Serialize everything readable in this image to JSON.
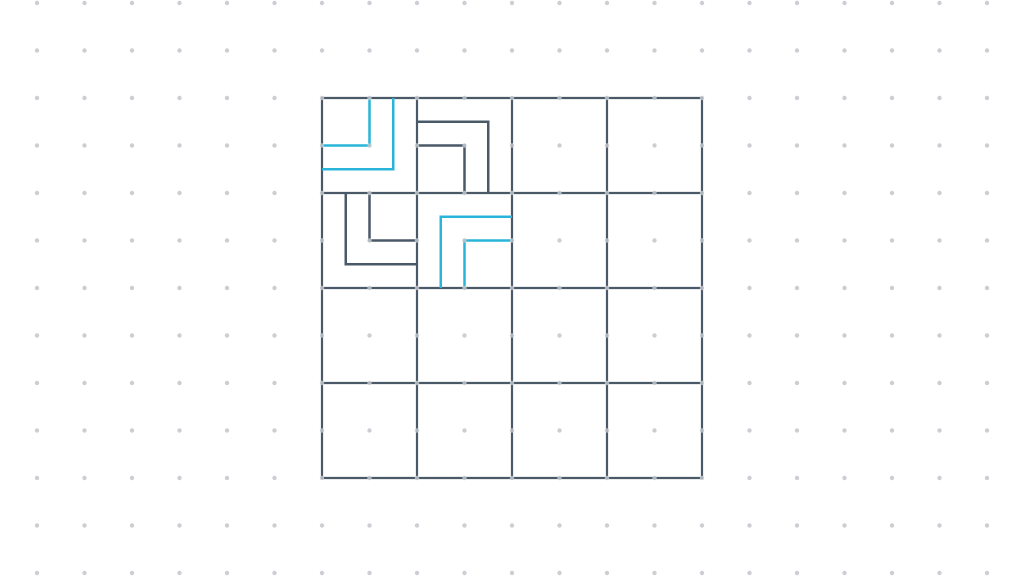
{
  "canvas": {
    "width": 1024,
    "height": 576,
    "background": "#ffffff"
  },
  "dot_grid": {
    "spacing": 47.5,
    "anchor_x": 322,
    "anchor_y": 98,
    "radius": 2.2,
    "color": "#c2c6cb",
    "opacity": 0.85
  },
  "grid": {
    "x": 322,
    "y": 98,
    "rows": 4,
    "cols": 4,
    "cell_size": 95,
    "line_color": "#4a5968",
    "line_width": 2.2
  },
  "colors": {
    "dark": "#4a5968",
    "cyan": "#28b5d9"
  },
  "shape_line_width": 2.5,
  "shapes": [
    {
      "name": "elbow-cell-0-0-inner",
      "cell": [
        0,
        0
      ],
      "connects": [
        "top",
        "left"
      ],
      "color": "cyan",
      "points": [
        [
          369.5,
          98
        ],
        [
          369.5,
          145.5
        ],
        [
          322,
          145.5
        ]
      ]
    },
    {
      "name": "elbow-cell-0-0-outer",
      "cell": [
        0,
        0
      ],
      "connects": [
        "top",
        "left"
      ],
      "color": "cyan",
      "points": [
        [
          393.25,
          98
        ],
        [
          393.25,
          169.25
        ],
        [
          322,
          169.25
        ]
      ]
    },
    {
      "name": "elbow-cell-0-1-inner",
      "cell": [
        0,
        1
      ],
      "connects": [
        "left",
        "bottom"
      ],
      "color": "dark",
      "points": [
        [
          417,
          145.5
        ],
        [
          464.5,
          145.5
        ],
        [
          464.5,
          193
        ]
      ]
    },
    {
      "name": "elbow-cell-0-1-outer",
      "cell": [
        0,
        1
      ],
      "connects": [
        "left",
        "bottom"
      ],
      "color": "dark",
      "points": [
        [
          417,
          121.75
        ],
        [
          488.25,
          121.75
        ],
        [
          488.25,
          193
        ]
      ]
    },
    {
      "name": "elbow-cell-1-0-inner",
      "cell": [
        1,
        0
      ],
      "connects": [
        "top",
        "right"
      ],
      "color": "dark",
      "points": [
        [
          369.5,
          193
        ],
        [
          369.5,
          240.5
        ],
        [
          417,
          240.5
        ]
      ]
    },
    {
      "name": "elbow-cell-1-0-outer",
      "cell": [
        1,
        0
      ],
      "connects": [
        "top",
        "right"
      ],
      "color": "dark",
      "points": [
        [
          345.75,
          193
        ],
        [
          345.75,
          264.25
        ],
        [
          417,
          264.25
        ]
      ]
    },
    {
      "name": "elbow-cell-1-1-inner",
      "cell": [
        1,
        1
      ],
      "connects": [
        "bottom",
        "right"
      ],
      "color": "cyan",
      "points": [
        [
          464.5,
          288
        ],
        [
          464.5,
          240.5
        ],
        [
          512,
          240.5
        ]
      ]
    },
    {
      "name": "elbow-cell-1-1-outer",
      "cell": [
        1,
        1
      ],
      "connects": [
        "bottom",
        "right"
      ],
      "color": "cyan",
      "points": [
        [
          440.75,
          288
        ],
        [
          440.75,
          216.75
        ],
        [
          512,
          216.75
        ]
      ]
    }
  ]
}
